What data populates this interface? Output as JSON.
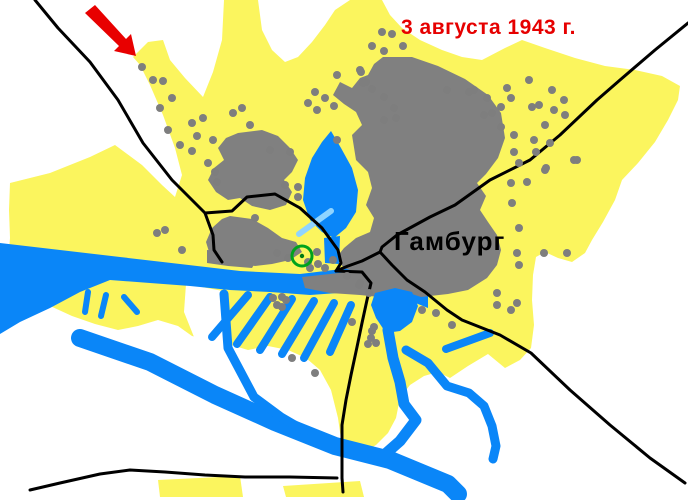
{
  "page": {
    "width": 688,
    "height": 500,
    "background": "#FFFFFF"
  },
  "map": {
    "annotation": {
      "date_label": "3 августа 1943 г.",
      "date_color": "#E60000",
      "city_label": "Гамбург",
      "city_color": "#000000"
    },
    "colors": {
      "urban_area": "#FBF55E",
      "destroyed_area": "#808080",
      "water": "#0A86F8",
      "water_light": "#8FD4FF",
      "road": "#000000",
      "bomb_dot": "#7E7E7E",
      "arrow": "#E80000",
      "target_ring": "#00A31C",
      "target_dot": "#007A12",
      "white": "#FFFFFF"
    },
    "dot_radius": 4,
    "arrow": {
      "points": "95,5 126,39 131,34 136,56 114,51 119,46 85,13"
    },
    "target_marker": {
      "x": 302,
      "y": 256,
      "r": 10,
      "ring_width": 3,
      "dot_r": 2.2
    },
    "layers": [
      {
        "name": "urban-area",
        "mode": "fill",
        "color": "urban_area",
        "items": [
          {
            "d": "M133,57 L148,42 L163,40 L170,60 L185,78 L203,97 L213,72 L222,40 L224,0 L258,0 L262,30 L272,50 L285,62 L298,57 L312,42 L325,25 L335,10 L350,0 L382,0 L390,15 L402,28 L420,40 L442,50 L462,57 L482,60 L505,48 L522,40 L545,48 L575,58 L605,66 L635,70 L662,76 L680,86 L678,100 L668,120 L655,142 L638,163 L622,180 L615,200 L603,222 L592,240 L585,253 L572,262 L558,258 L545,252 L536,257 L533,275 L532,300 L534,325 L531,348 L520,360 L505,368 L488,354 L468,366 L450,378 L438,372 L424,376 L410,385 L400,398 L396,418 L388,433 L376,445 L362,453 L348,456 L342,446 L338,418 L331,390 L320,370 L306,358 L288,350 L268,346 L248,350 L228,344 L208,340 L192,336 L178,326 L158,320 L138,326 L118,330 L95,324 L72,316 L48,305 L25,294 L10,286 L8,262 L10,238 L9,210 L10,183 L50,173 L90,157 L115,145 L142,165 L162,185 L175,197 L182,175 L175,148 L163,115 L150,85 L140,65 Z"
          },
          {
            "d": "M158,480 L240,476 L243,497 L160,497 Z"
          },
          {
            "d": "M283,486 L360,481 L364,497 L286,497 Z"
          }
        ]
      },
      {
        "name": "white-cutout",
        "mode": "fill",
        "color": "white",
        "items": [
          {
            "d": "M186,284 L228,292 L232,356 L196,342 L184,312 Z"
          }
        ]
      },
      {
        "name": "river-elbe-main",
        "mode": "fill",
        "color": "water",
        "items": [
          {
            "d": "M0,243 L60,250 L120,257 L180,264 L240,271 L300,274 L350,268 L395,274 L428,288 L428,308 L398,296 L352,292 L310,295 L270,292 L230,290 L190,286 L150,283 L110,280 L80,292 L50,308 L20,322 L0,334 Z"
          }
        ]
      },
      {
        "name": "destroyed-area",
        "mode": "fill",
        "color": "destroyed_area",
        "items": [
          {
            "d": "M383,57 L412,57 L438,66 L465,79 L488,95 L501,113 L505,138 L498,158 L486,174 L477,183 L486,196 L480,210 L488,222 L497,235 L501,250 L497,265 L487,278 L468,290 L448,294 L421,297 L400,290 L374,282 L356,272 L344,268 L336,258 L344,248 L356,238 L370,232 L374,218 L366,205 L372,188 L368,172 L356,160 L352,135 L362,125 L356,112 L344,104 L333,95 L340,82 L352,88 L360,78 L368,75 L374,64 Z"
          },
          {
            "d": "M238,133 L262,130 L278,136 L290,148 L298,160 L292,172 L284,180 L292,192 L286,205 L270,210 L252,206 L240,198 L228,200 L216,192 L208,180 L214,168 L224,160 L218,148 L226,138 Z"
          },
          {
            "d": "M230,216 L252,219 L268,228 L282,238 L296,242 L302,252 L290,260 L272,264 L255,266 L238,263 L222,262 L210,255 L206,242 L212,228 L222,219 Z"
          },
          {
            "d": "M302,277 L330,274 L355,271 L380,274 L405,280 L408,292 L390,298 L360,295 L330,293 L305,288 Z"
          },
          {
            "d": "M207,250 L235,252 L258,258 L252,268 L228,266 L207,263 Z"
          }
        ]
      },
      {
        "name": "water-features",
        "mode": "fill",
        "color": "water",
        "items": [
          {
            "d": "M331,131 L341,148 L352,168 L358,190 L356,212 L346,228 L334,238 L322,232 L310,220 L303,200 L305,178 L312,158 L322,142 Z"
          },
          {
            "d": "M324,238 L340,236 L339,264 L325,263 Z"
          },
          {
            "d": "M375,293 L395,288 L412,292 L418,306 L412,322 L400,331 L386,333 L376,318 L371,305 Z"
          }
        ]
      },
      {
        "name": "water-channels",
        "mode": "stroke",
        "color": "water",
        "items": [
          {
            "d": "M80,338 L150,362 L215,395 L275,422 L335,446 L390,460 L448,484 L458,494",
            "w": 18
          },
          {
            "d": "M388,330 L393,358 L400,382 L404,404 L416,420 L400,441 L383,456",
            "w": 11
          },
          {
            "d": "M406,350 L428,363 L447,386 L469,393 L484,406 L492,426 L496,446 L493,459",
            "w": 9
          },
          {
            "d": "M224,294 L228,348 L254,397 L281,417 L305,431",
            "w": 9
          },
          {
            "d": "M446,349 L490,333",
            "w": 8
          },
          {
            "d": "M248,295 L212,337",
            "w": 8
          },
          {
            "d": "M270,297 L237,344",
            "w": 8
          },
          {
            "d": "M292,299 L260,350",
            "w": 8
          },
          {
            "d": "M314,301 L282,354",
            "w": 8
          },
          {
            "d": "M334,303 L304,358",
            "w": 8
          },
          {
            "d": "M351,305 L330,352",
            "w": 8
          },
          {
            "d": "M88,292 L85,312",
            "w": 6
          },
          {
            "d": "M106,295 L101,316",
            "w": 6
          },
          {
            "d": "M124,297 L137,312",
            "w": 6
          },
          {
            "d": "M331,211 L299,234",
            "w": 6,
            "color": "water_light"
          }
        ]
      },
      {
        "name": "roads",
        "mode": "stroke",
        "color": "road",
        "items": [
          {
            "name": "road-northwest",
            "d": "M35,0 L58,28 L90,62 L118,100 L143,143 L172,180 L205,213 L213,235 L214,250 L222,262",
            "w": 3
          },
          {
            "name": "road-inner-ring",
            "d": "M205,213 L232,211 L247,197 L275,194 L300,208 L322,228 L338,250 L341,263 L336,271",
            "w": 3
          },
          {
            "name": "road-south",
            "d": "M336,271 L362,272 L371,283 L367,300 L362,323 L357,347 L351,375 L346,400 L342,425 L342,455 L342,478 L343,492",
            "w": 3
          },
          {
            "name": "road-northeast",
            "d": "M688,23 L655,50 L620,80 L597,100 L560,135 L530,160 L490,180 L455,205 L430,217 L397,235 L382,247 L380,252 L362,261 L348,266 L336,271",
            "w": 3
          },
          {
            "name": "road-southeast",
            "d": "M380,252 L392,265 L407,280 L425,292 L447,310 L462,320 L500,335 L531,353 L570,390 L610,425 L650,458 L685,483",
            "w": 3
          },
          {
            "name": "road-bottom",
            "d": "M30,490 L60,483 L100,474 L130,470 L165,472 L205,475 L245,477 L290,477 L337,478",
            "w": 3
          }
        ]
      }
    ],
    "bomb_dots": [
      [
        142,
        67
      ],
      [
        153,
        80
      ],
      [
        163,
        81
      ],
      [
        172,
        98
      ],
      [
        160,
        108
      ],
      [
        168,
        130
      ],
      [
        180,
        145
      ],
      [
        192,
        123
      ],
      [
        203,
        118
      ],
      [
        197,
        136
      ],
      [
        192,
        151
      ],
      [
        213,
        140
      ],
      [
        233,
        113
      ],
      [
        242,
        108
      ],
      [
        250,
        125
      ],
      [
        290,
        152
      ],
      [
        270,
        150
      ],
      [
        255,
        218
      ],
      [
        315,
        92
      ],
      [
        308,
        103
      ],
      [
        317,
        110
      ],
      [
        325,
        98
      ],
      [
        334,
        106
      ],
      [
        337,
        75
      ],
      [
        360,
        70
      ],
      [
        363,
        83
      ],
      [
        372,
        89
      ],
      [
        337,
        140
      ],
      [
        382,
        32
      ],
      [
        392,
        34
      ],
      [
        372,
        46
      ],
      [
        384,
        51
      ],
      [
        403,
        46
      ],
      [
        361,
        72
      ],
      [
        366,
        82
      ],
      [
        384,
        97
      ],
      [
        394,
        108
      ],
      [
        384,
        120
      ],
      [
        396,
        118
      ],
      [
        447,
        90
      ],
      [
        469,
        92
      ],
      [
        474,
        90
      ],
      [
        487,
        98
      ],
      [
        484,
        115
      ],
      [
        492,
        113
      ],
      [
        501,
        107
      ],
      [
        507,
        88
      ],
      [
        511,
        98
      ],
      [
        529,
        80
      ],
      [
        532,
        107
      ],
      [
        539,
        105
      ],
      [
        552,
        90
      ],
      [
        554,
        110
      ],
      [
        564,
        100
      ],
      [
        565,
        115
      ],
      [
        545,
        125
      ],
      [
        550,
        143
      ],
      [
        577,
        160
      ],
      [
        545,
        170
      ],
      [
        501,
        127
      ],
      [
        514,
        135
      ],
      [
        534,
        140
      ],
      [
        536,
        152
      ],
      [
        514,
        152
      ],
      [
        519,
        163
      ],
      [
        527,
        182
      ],
      [
        546,
        168
      ],
      [
        574,
        160
      ],
      [
        511,
        183
      ],
      [
        512,
        203
      ],
      [
        519,
        228
      ],
      [
        517,
        253
      ],
      [
        544,
        253
      ],
      [
        567,
        253
      ],
      [
        519,
        265
      ],
      [
        497,
        293
      ],
      [
        497,
        305
      ],
      [
        511,
        310
      ],
      [
        517,
        303
      ],
      [
        422,
        310
      ],
      [
        436,
        313
      ],
      [
        452,
        325
      ],
      [
        359,
        285
      ],
      [
        369,
        293
      ],
      [
        374,
        327
      ],
      [
        371,
        338
      ],
      [
        376,
        343
      ],
      [
        352,
        322
      ],
      [
        273,
        298
      ],
      [
        282,
        297
      ],
      [
        277,
        305
      ],
      [
        282,
        307
      ],
      [
        286,
        300
      ],
      [
        292,
        358
      ],
      [
        315,
        373
      ],
      [
        208,
        163
      ],
      [
        215,
        172
      ],
      [
        217,
        182
      ],
      [
        157,
        233
      ],
      [
        165,
        230
      ],
      [
        277,
        253
      ],
      [
        288,
        258
      ],
      [
        308,
        262
      ],
      [
        317,
        252
      ],
      [
        318,
        264
      ],
      [
        325,
        268
      ],
      [
        333,
        260
      ],
      [
        310,
        268
      ],
      [
        285,
        185
      ],
      [
        298,
        187
      ],
      [
        298,
        197
      ],
      [
        347,
        276
      ],
      [
        360,
        283
      ],
      [
        372,
        331
      ],
      [
        368,
        344
      ],
      [
        182,
        250
      ]
    ]
  }
}
